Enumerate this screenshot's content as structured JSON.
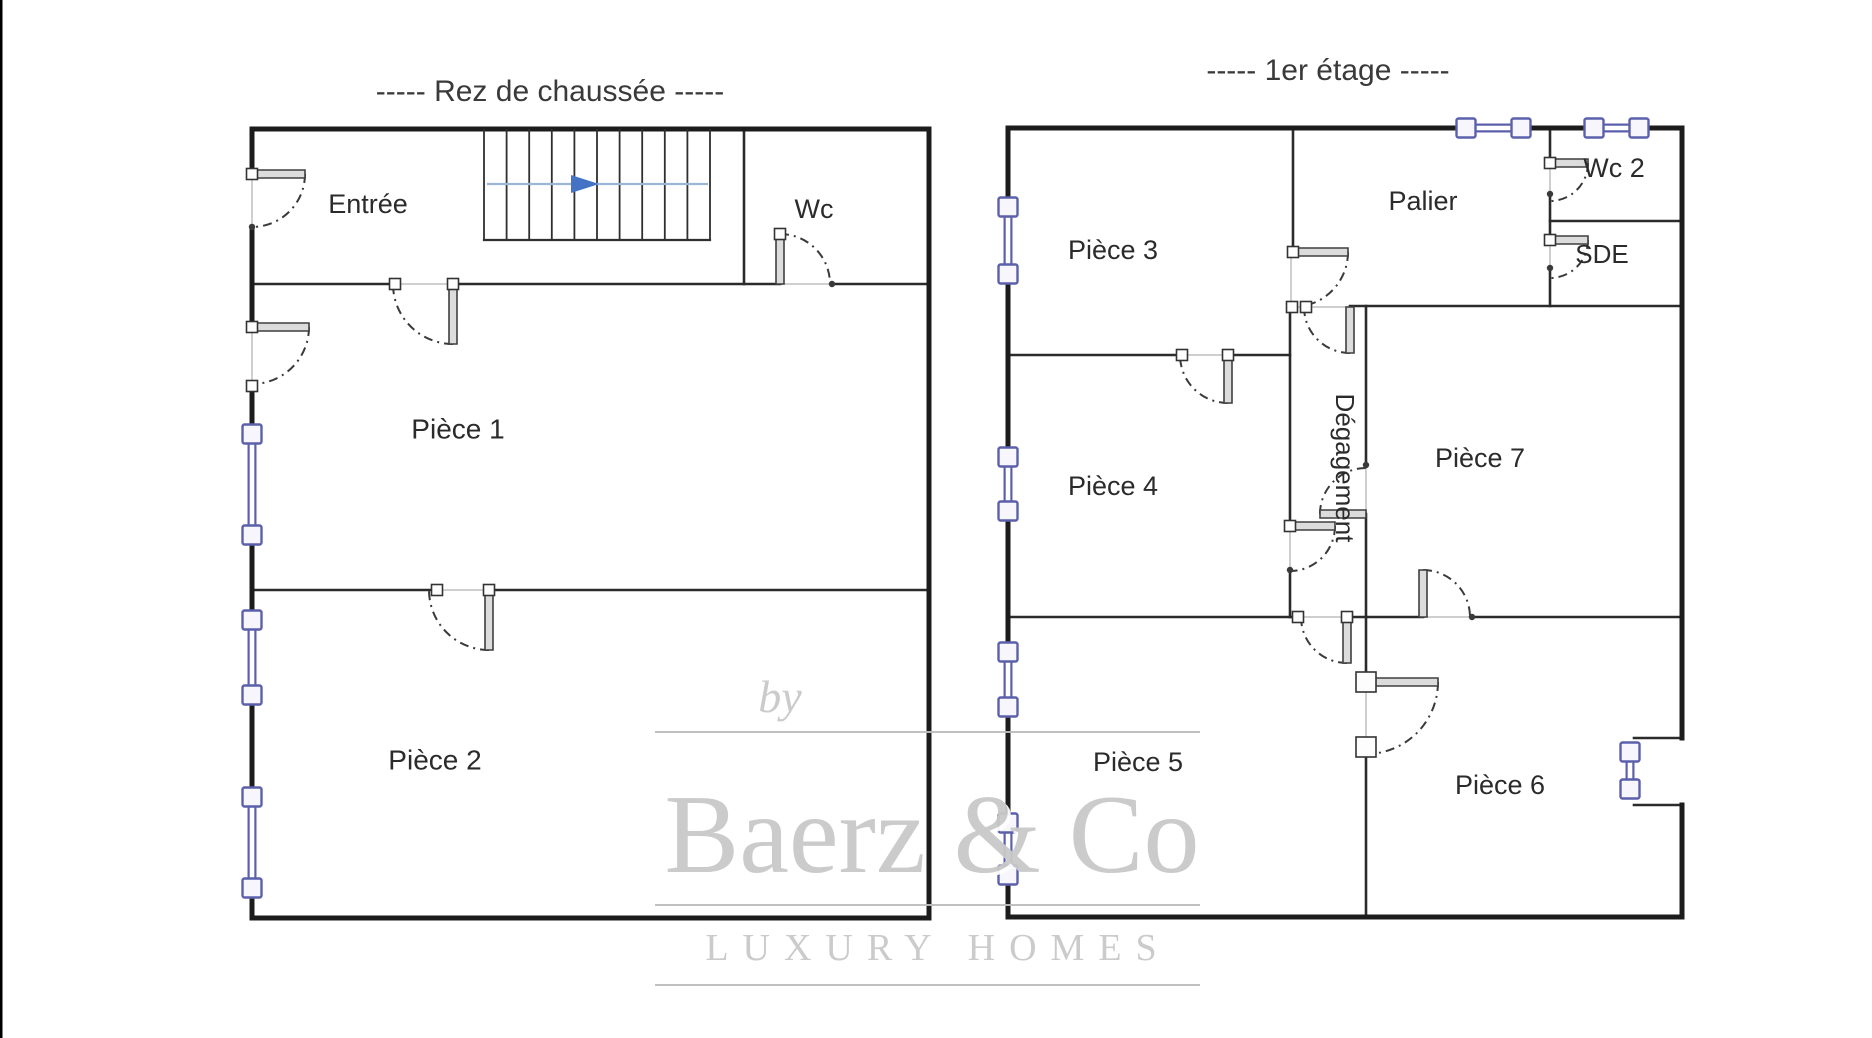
{
  "page": {
    "canvas": {
      "width": 1872,
      "height": 1038
    },
    "background": "#ffffff",
    "left_edge_line": {
      "x": 1,
      "color": "#000000",
      "width": 3
    }
  },
  "colors": {
    "outer_wall": "#1c1c1c",
    "inner_wall": "#2b2b2b",
    "opening": "#cfcfcf",
    "arc": "#3a3a3a",
    "leaf_fill": "#dcdcdc",
    "leaf_stroke": "#3f3f3f",
    "square_fill": "#fdfdfd",
    "square_stroke": "#333333",
    "window_stroke": "#5c60ab",
    "window_fill": "#f6f6fc",
    "stair_line": "#2f2f2f",
    "arrow_line": "#9ab7d8",
    "arrow_head": "#4472c4",
    "label": "#2b2b2b",
    "title": "#3a3a3a",
    "watermark_text": "#c9c9c9",
    "watermark_line": "#bdbdbd"
  },
  "floors": [
    {
      "id": "rdc",
      "title": "-----  Rez de chaussée  -----",
      "title_pos": {
        "x": 550,
        "y": 101,
        "size": 30
      },
      "outer_walls": [
        {
          "x1": 252,
          "y1": 129,
          "x2": 929,
          "y2": 129
        },
        {
          "x1": 929,
          "y1": 129,
          "x2": 929,
          "y2": 918
        },
        {
          "x1": 252,
          "y1": 918,
          "x2": 929,
          "y2": 918
        },
        {
          "x1": 252,
          "y1": 129,
          "x2": 252,
          "y2": 174
        },
        {
          "x1": 252,
          "y1": 227,
          "x2": 252,
          "y2": 327
        },
        {
          "x1": 252,
          "y1": 386,
          "x2": 252,
          "y2": 425
        },
        {
          "x1": 252,
          "y1": 544,
          "x2": 252,
          "y2": 611
        },
        {
          "x1": 252,
          "y1": 704,
          "x2": 252,
          "y2": 788
        },
        {
          "x1": 252,
          "y1": 897,
          "x2": 252,
          "y2": 918
        }
      ],
      "inner_walls": [
        {
          "x1": 252,
          "y1": 284,
          "x2": 395,
          "y2": 284
        },
        {
          "x1": 453,
          "y1": 284,
          "x2": 780,
          "y2": 284
        },
        {
          "x1": 832,
          "y1": 284,
          "x2": 929,
          "y2": 284
        },
        {
          "x1": 744,
          "y1": 129,
          "x2": 744,
          "y2": 284
        },
        {
          "x1": 252,
          "y1": 590,
          "x2": 437,
          "y2": 590
        },
        {
          "x1": 489,
          "y1": 590,
          "x2": 929,
          "y2": 590
        }
      ],
      "openings": [
        {
          "x1": 252,
          "y1": 174,
          "x2": 252,
          "y2": 227
        },
        {
          "x1": 252,
          "y1": 327,
          "x2": 252,
          "y2": 386
        },
        {
          "x1": 395,
          "y1": 284,
          "x2": 453,
          "y2": 284
        },
        {
          "x1": 780,
          "y1": 284,
          "x2": 832,
          "y2": 284
        },
        {
          "x1": 437,
          "y1": 590,
          "x2": 489,
          "y2": 590
        }
      ],
      "doors": [
        {
          "id": "entree-door",
          "hinge": [
            252,
            174
          ],
          "leaf_end": [
            305,
            174
          ],
          "arc_end": [
            252,
            227
          ],
          "squares": [
            [
              252,
              174
            ]
          ],
          "dots": [
            [
              252,
              227
            ]
          ]
        },
        {
          "id": "piece1-left-door",
          "hinge": [
            252,
            327
          ],
          "leaf_end": [
            309,
            327
          ],
          "arc_end": [
            252,
            386
          ],
          "squares": [
            [
              252,
              327
            ],
            [
              252,
              386
            ]
          ],
          "dots": []
        },
        {
          "id": "entree-piece1-door",
          "hinge": [
            453,
            284
          ],
          "leaf_end": [
            453,
            344
          ],
          "arc_end": [
            395,
            284
          ],
          "squares": [
            [
              395,
              284
            ],
            [
              453,
              284
            ]
          ],
          "dots": []
        },
        {
          "id": "wc-door",
          "hinge": [
            780,
            284
          ],
          "leaf_end": [
            780,
            234
          ],
          "arc_end": [
            832,
            284
          ],
          "squares": [
            [
              780,
              234
            ]
          ],
          "dots": [
            [
              832,
              284
            ]
          ]
        },
        {
          "id": "piece1-piece2-door",
          "hinge": [
            489,
            590
          ],
          "leaf_end": [
            489,
            650
          ],
          "arc_end": [
            437,
            590
          ],
          "squares": [
            [
              437,
              590
            ],
            [
              489,
              590
            ]
          ],
          "dots": []
        }
      ],
      "windows": [
        {
          "id": "rdc-window-1",
          "a": [
            252,
            434
          ],
          "b": [
            252,
            535
          ]
        },
        {
          "id": "rdc-window-2",
          "a": [
            252,
            620
          ],
          "b": [
            252,
            695
          ]
        },
        {
          "id": "rdc-window-3",
          "a": [
            252,
            797
          ],
          "b": [
            252,
            888
          ]
        }
      ],
      "stairs": {
        "x0": 484,
        "x1": 710,
        "y0": 129,
        "y1": 240,
        "treads": 11,
        "arrow": {
          "y": 184,
          "x0": 487,
          "x1": 708,
          "tri_x0": 571,
          "tri_x1": 599,
          "tri_h": 18
        }
      },
      "labels": [
        {
          "text": "Entrée",
          "x": 368,
          "y": 206,
          "size": 27
        },
        {
          "text": "Wc",
          "x": 814,
          "y": 211,
          "size": 27
        },
        {
          "text": "Pièce 1",
          "x": 458,
          "y": 431,
          "size": 28
        },
        {
          "text": "Pièce 2",
          "x": 435,
          "y": 762,
          "size": 28
        }
      ]
    },
    {
      "id": "etage1",
      "title": "-----  1er étage  -----",
      "title_pos": {
        "x": 1328,
        "y": 80,
        "size": 30
      },
      "outer_walls": [
        {
          "x1": 1008,
          "y1": 128,
          "x2": 1457,
          "y2": 128
        },
        {
          "x1": 1530,
          "y1": 128,
          "x2": 1585,
          "y2": 128
        },
        {
          "x1": 1648,
          "y1": 128,
          "x2": 1682,
          "y2": 128
        },
        {
          "x1": 1682,
          "y1": 128,
          "x2": 1682,
          "y2": 738
        },
        {
          "x1": 1682,
          "y1": 805,
          "x2": 1682,
          "y2": 917
        },
        {
          "x1": 1008,
          "y1": 917,
          "x2": 1682,
          "y2": 917
        },
        {
          "x1": 1008,
          "y1": 128,
          "x2": 1008,
          "y2": 198
        },
        {
          "x1": 1008,
          "y1": 283,
          "x2": 1008,
          "y2": 448
        },
        {
          "x1": 1008,
          "y1": 520,
          "x2": 1008,
          "y2": 643
        },
        {
          "x1": 1008,
          "y1": 716,
          "x2": 1008,
          "y2": 814
        },
        {
          "x1": 1008,
          "y1": 884,
          "x2": 1008,
          "y2": 917
        }
      ],
      "inner_walls": [
        {
          "x1": 1293,
          "y1": 128,
          "x2": 1293,
          "y2": 252
        },
        {
          "x1": 1550,
          "y1": 128,
          "x2": 1550,
          "y2": 163
        },
        {
          "x1": 1550,
          "y1": 194,
          "x2": 1550,
          "y2": 240
        },
        {
          "x1": 1550,
          "y1": 268,
          "x2": 1550,
          "y2": 306
        },
        {
          "x1": 1550,
          "y1": 221,
          "x2": 1682,
          "y2": 221
        },
        {
          "x1": 1350,
          "y1": 306,
          "x2": 1682,
          "y2": 306
        },
        {
          "x1": 1008,
          "y1": 355,
          "x2": 1182,
          "y2": 355
        },
        {
          "x1": 1228,
          "y1": 355,
          "x2": 1290,
          "y2": 355
        },
        {
          "x1": 1290,
          "y1": 306,
          "x2": 1290,
          "y2": 526
        },
        {
          "x1": 1290,
          "y1": 570,
          "x2": 1290,
          "y2": 617
        },
        {
          "x1": 1366,
          "y1": 306,
          "x2": 1366,
          "y2": 465
        },
        {
          "x1": 1366,
          "y1": 514,
          "x2": 1366,
          "y2": 617
        },
        {
          "x1": 1008,
          "y1": 617,
          "x2": 1298,
          "y2": 617
        },
        {
          "x1": 1347,
          "y1": 617,
          "x2": 1423,
          "y2": 617
        },
        {
          "x1": 1472,
          "y1": 617,
          "x2": 1682,
          "y2": 617
        },
        {
          "x1": 1366,
          "y1": 617,
          "x2": 1366,
          "y2": 682
        },
        {
          "x1": 1366,
          "y1": 747,
          "x2": 1366,
          "y2": 917
        },
        {
          "x1": 1634,
          "y1": 738,
          "x2": 1682,
          "y2": 738
        },
        {
          "x1": 1634,
          "y1": 805,
          "x2": 1682,
          "y2": 805
        }
      ],
      "openings": [
        {
          "x1": 1291,
          "y1": 252,
          "x2": 1291,
          "y2": 307
        },
        {
          "x1": 1290,
          "y1": 307,
          "x2": 1350,
          "y2": 307
        },
        {
          "x1": 1182,
          "y1": 355,
          "x2": 1228,
          "y2": 355
        },
        {
          "x1": 1550,
          "y1": 163,
          "x2": 1550,
          "y2": 194
        },
        {
          "x1": 1550,
          "y1": 240,
          "x2": 1550,
          "y2": 268
        },
        {
          "x1": 1366,
          "y1": 465,
          "x2": 1366,
          "y2": 514
        },
        {
          "x1": 1290,
          "y1": 526,
          "x2": 1290,
          "y2": 570
        },
        {
          "x1": 1298,
          "y1": 617,
          "x2": 1347,
          "y2": 617
        },
        {
          "x1": 1423,
          "y1": 617,
          "x2": 1472,
          "y2": 617
        },
        {
          "x1": 1366,
          "y1": 682,
          "x2": 1366,
          "y2": 747
        }
      ],
      "doors": [
        {
          "id": "palier-degagement-door",
          "hinge": [
            1293,
            252
          ],
          "leaf_end": [
            1348,
            252
          ],
          "arc_end": [
            1293,
            306
          ],
          "squares": [
            [
              1293,
              252
            ]
          ],
          "dots": []
        },
        {
          "id": "degagement-top-door",
          "hinge": [
            1350,
            307
          ],
          "leaf_end": [
            1350,
            353
          ],
          "arc_end": [
            1306,
            307
          ],
          "squares": [
            [
              1292,
              307
            ],
            [
              1306,
              307
            ]
          ],
          "dots": []
        },
        {
          "id": "piece3-door",
          "hinge": [
            1228,
            355
          ],
          "leaf_end": [
            1228,
            403
          ],
          "arc_end": [
            1182,
            355
          ],
          "squares": [
            [
              1182,
              355
            ],
            [
              1228,
              355
            ]
          ],
          "dots": []
        },
        {
          "id": "wc2-door",
          "hinge": [
            1550,
            163
          ],
          "leaf_end": [
            1588,
            163
          ],
          "arc_end": [
            1550,
            194
          ],
          "squares": [
            [
              1550,
              163
            ]
          ],
          "dots": [
            [
              1550,
              194
            ]
          ]
        },
        {
          "id": "sde-door",
          "hinge": [
            1550,
            240
          ],
          "leaf_end": [
            1588,
            240
          ],
          "arc_end": [
            1550,
            268
          ],
          "squares": [
            [
              1550,
              240
            ]
          ],
          "dots": [
            [
              1550,
              268
            ]
          ]
        },
        {
          "id": "degagement-piece7-door",
          "hinge": [
            1366,
            514
          ],
          "leaf_end": [
            1320,
            514
          ],
          "arc_end": [
            1366,
            468
          ],
          "squares": [],
          "dots": [
            [
              1366,
              465
            ]
          ]
        },
        {
          "id": "piece4-degagement-door",
          "hinge": [
            1290,
            526
          ],
          "leaf_end": [
            1335,
            526
          ],
          "arc_end": [
            1290,
            570
          ],
          "squares": [
            [
              1290,
              526
            ]
          ],
          "dots": [
            [
              1290,
              570
            ]
          ]
        },
        {
          "id": "degagement-piece5-door",
          "hinge": [
            1347,
            617
          ],
          "leaf_end": [
            1347,
            663
          ],
          "arc_end": [
            1298,
            617
          ],
          "squares": [
            [
              1298,
              617
            ],
            [
              1347,
              617
            ]
          ],
          "dots": []
        },
        {
          "id": "piece7-piece6-door",
          "hinge": [
            1423,
            617
          ],
          "leaf_end": [
            1423,
            570
          ],
          "arc_end": [
            1472,
            617
          ],
          "squares": [],
          "dots": [
            [
              1472,
              617
            ]
          ]
        },
        {
          "id": "piece5-piece6-door",
          "hinge": [
            1366,
            682
          ],
          "leaf_end": [
            1438,
            682
          ],
          "arc_end": [
            1366,
            747
          ],
          "squares": [
            [
              1366,
              682
            ],
            [
              1366,
              747
            ]
          ],
          "dots": [],
          "big_hinge": true
        }
      ],
      "windows": [
        {
          "id": "et1-window-1",
          "a": [
            1008,
            207
          ],
          "b": [
            1008,
            274
          ]
        },
        {
          "id": "et1-window-2",
          "a": [
            1008,
            457
          ],
          "b": [
            1008,
            511
          ]
        },
        {
          "id": "et1-window-3",
          "a": [
            1008,
            652
          ],
          "b": [
            1008,
            707
          ]
        },
        {
          "id": "et1-window-4",
          "a": [
            1008,
            823
          ],
          "b": [
            1008,
            875
          ]
        },
        {
          "id": "et1-top-window-1",
          "a": [
            1466,
            128
          ],
          "b": [
            1521,
            128
          ]
        },
        {
          "id": "et1-top-window-2",
          "a": [
            1594,
            128
          ],
          "b": [
            1639,
            128
          ]
        },
        {
          "id": "piece6-window",
          "a": [
            1630,
            752
          ],
          "b": [
            1630,
            789
          ]
        }
      ],
      "labels": [
        {
          "text": "Pièce 3",
          "x": 1113,
          "y": 252,
          "size": 27
        },
        {
          "text": "Palier",
          "x": 1423,
          "y": 203,
          "size": 27
        },
        {
          "text": "Wc 2",
          "x": 1614,
          "y": 170,
          "size": 27
        },
        {
          "text": "SDE",
          "x": 1602,
          "y": 256,
          "size": 26
        },
        {
          "text": "Pièce 4",
          "x": 1113,
          "y": 488,
          "size": 27
        },
        {
          "text": "Dégagement",
          "x": 1343,
          "y": 468,
          "size": 26,
          "rotate": 90
        },
        {
          "text": "Pièce 7",
          "x": 1480,
          "y": 460,
          "size": 27
        },
        {
          "text": "Pièce 5",
          "x": 1138,
          "y": 764,
          "size": 27
        },
        {
          "text": "Pièce 6",
          "x": 1500,
          "y": 787,
          "size": 27
        }
      ]
    }
  ],
  "watermark": {
    "by": {
      "text": "by",
      "x": 780,
      "y": 712,
      "size": 46
    },
    "main": {
      "text": "Baerz & Co",
      "x": 932,
      "y": 872,
      "size": 112
    },
    "sub": {
      "text": "LUXURY HOMES",
      "x": 938,
      "y": 960,
      "size": 38,
      "letter_spacing": 14
    },
    "lines": [
      {
        "x1": 655,
        "y1": 732,
        "x2": 1200,
        "y2": 732
      },
      {
        "x1": 655,
        "y1": 905,
        "x2": 1200,
        "y2": 905
      },
      {
        "x1": 655,
        "y1": 985,
        "x2": 1200,
        "y2": 985
      }
    ]
  }
}
